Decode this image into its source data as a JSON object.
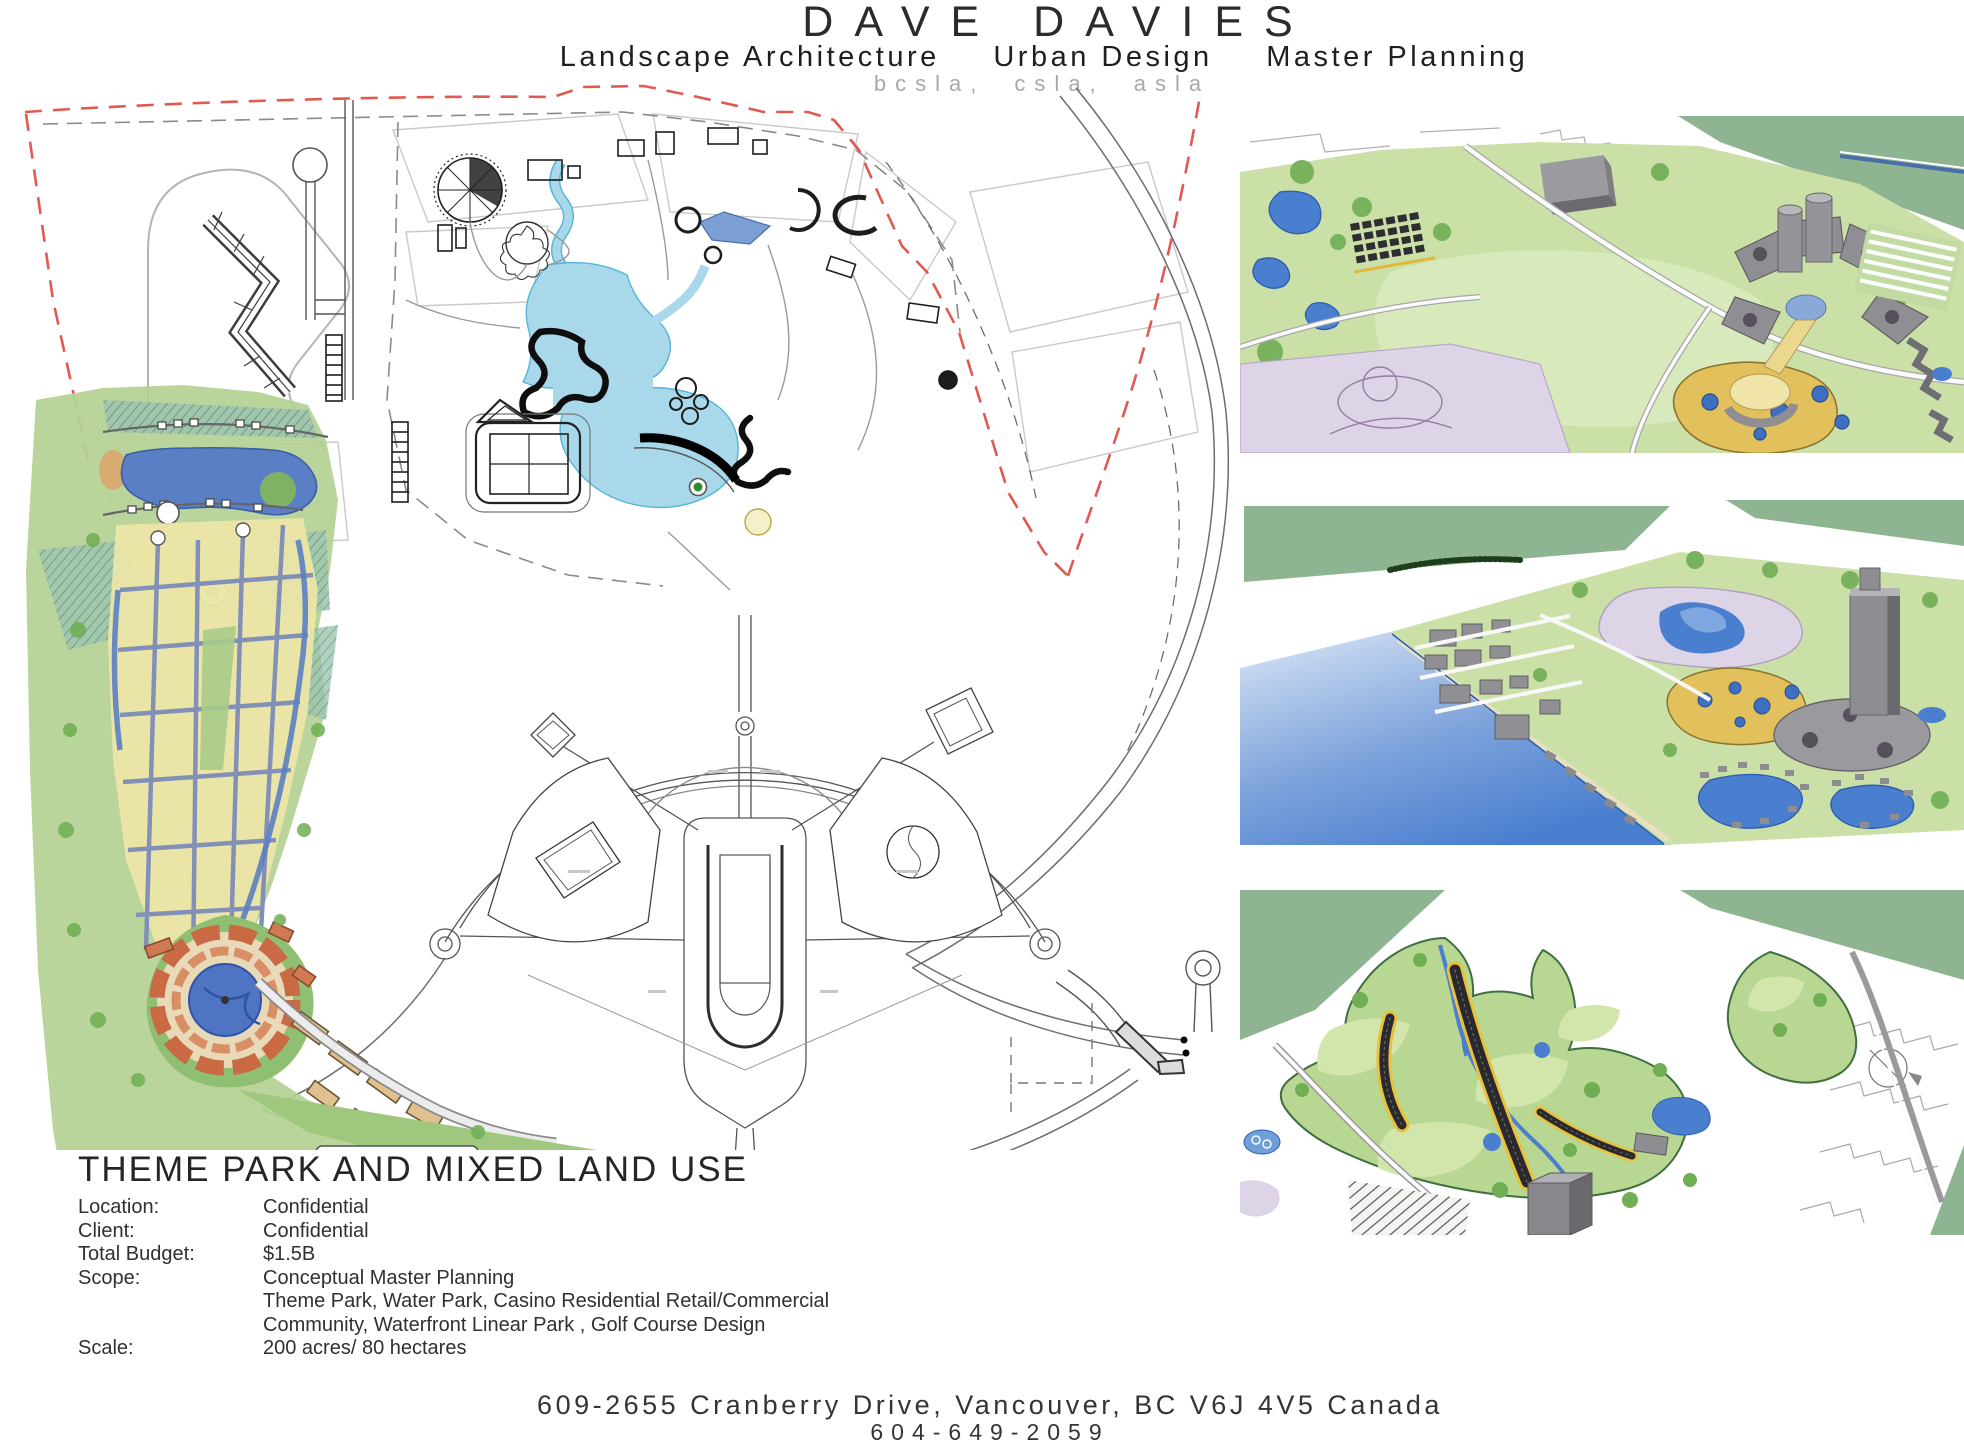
{
  "header": {
    "title": "DAVE DAVIES",
    "subtitle_parts": [
      "Landscape Architecture",
      "Urban Design",
      "Master Planning"
    ],
    "credentials": "bcsla, csla, asla"
  },
  "project": {
    "title": "THEME PARK AND MIXED LAND USE",
    "details": [
      {
        "label": "Location:",
        "value": "Confidential"
      },
      {
        "label": "Client:",
        "value": "Confidential"
      },
      {
        "label": "Total Budget:",
        "value": "$1.5B"
      },
      {
        "label": "Scope:",
        "value": "Conceptual Master Planning"
      },
      {
        "label": "",
        "value": "Theme Park, Water Park, Casino Residential Retail/Commercial"
      },
      {
        "label": "",
        "value": "Community, Waterfront Linear Park , Golf Course Design"
      },
      {
        "label": "Scale:",
        "value": "200 acres/ 80 hectares"
      }
    ]
  },
  "footer": {
    "address": "609-2655 Cranberry Drive, Vancouver, BC V6J 4V5 Canada",
    "phone": "604-649-2059"
  },
  "palette": {
    "header_text": "#2b2b2b",
    "credentials_gray": "#a8a8a8",
    "boundary_red": "#e05a52",
    "plan_line": "#555555",
    "lake_light_blue": "#a8d8ea",
    "river_blue": "#7b9fd4",
    "sketch_lake_blue": "#5b7fc4",
    "sketch_yellow": "#ece6a8",
    "sketch_green": "#b3d193",
    "sketch_teal": "#6fa391",
    "stadium_orange": "#c96a45",
    "sand_tan": "#dfc08e",
    "render_band_green": "#8fb491",
    "render_grass": "#cbe0a6",
    "render_tree_green": "#79b25c",
    "render_water_blue": "#4a7fd0",
    "render_pond_yellow": "#e2c05c",
    "render_lavender": "#ddd4e8",
    "render_building_gray": "#8e8e92"
  }
}
